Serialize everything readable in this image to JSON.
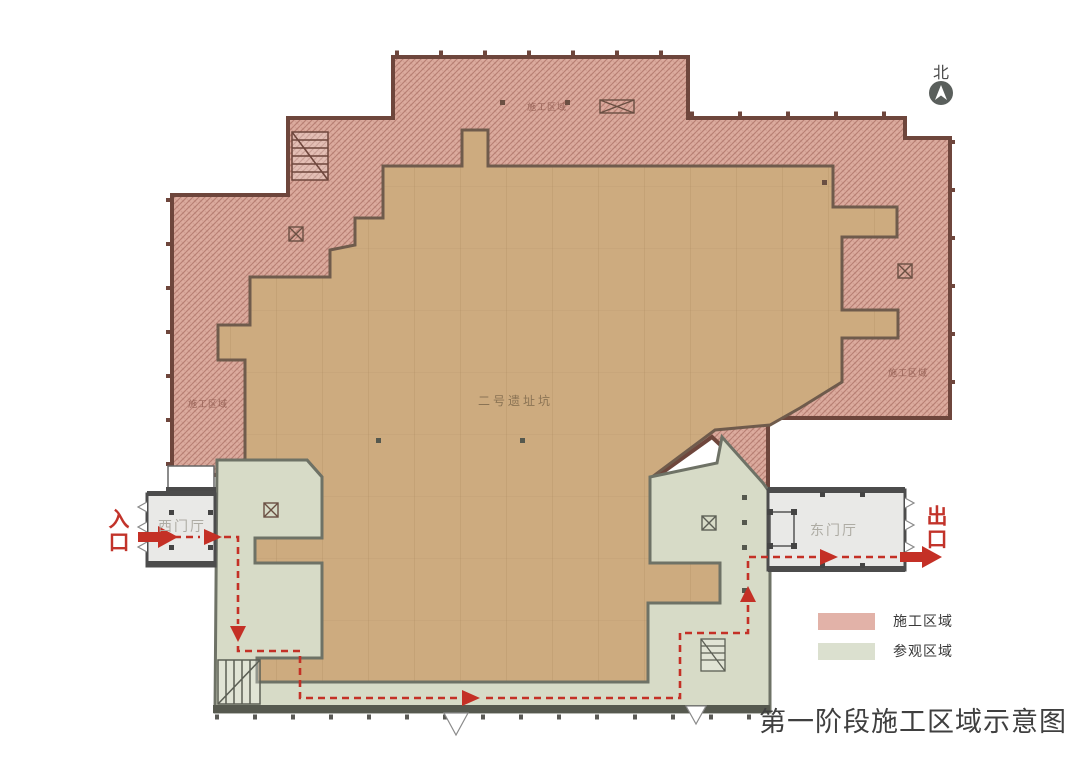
{
  "title": "第一阶段施工区域示意图",
  "north": {
    "label": "北"
  },
  "entrance": {
    "label": "入口"
  },
  "exit": {
    "label": "出口"
  },
  "halls": {
    "west": {
      "label": "西门厅"
    },
    "east": {
      "label": "东门厅"
    }
  },
  "pit": {
    "label": "二号遗址坑"
  },
  "plan_labels": {
    "construction": "施工区域"
  },
  "legend": {
    "items": [
      {
        "label": "施工区域",
        "color": "#e2b2a8"
      },
      {
        "label": "参观区域",
        "color": "#dbe0cf"
      }
    ]
  },
  "colors": {
    "construction_fill": "#dcab9e",
    "construction_wall": "#6e463c",
    "pit_fill": "#cdab7f",
    "visitor_fill": "#d7dbc7",
    "visitor_wall": "#6e7266",
    "hall_fill": "#e9e9e7",
    "route": "#c43026"
  }
}
